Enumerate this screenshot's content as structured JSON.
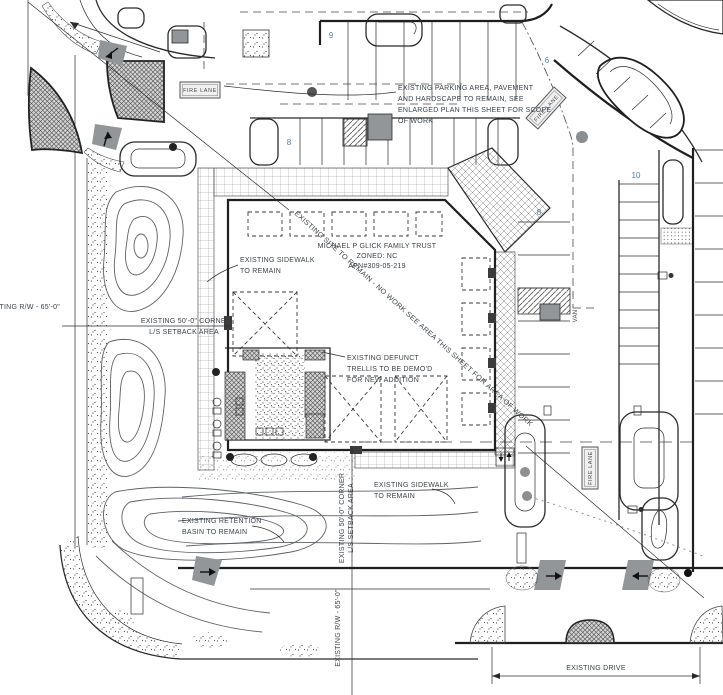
{
  "drawing": {
    "type": "architectural-site-plan",
    "colors": {
      "ink": "#2b2b2b",
      "label": "#3b4249",
      "count_blue": "#4a7cb5",
      "gray": "#939699"
    },
    "fire_lane": "FIRE LANE",
    "counts": {
      "top_row": "9",
      "entry_row": "6",
      "second_row": "8",
      "east_row": "8",
      "far_east_row": "10"
    },
    "labels": {
      "parking_note": {
        "l1": "EXISTING PARKING AREA, PAVEMENT",
        "l2": "AND HARDSCAPE TO REMAIN, SEE",
        "l3": "ENLARGED PLAN THIS SHEET FOR SCOPE",
        "l4": "OF WORK"
      },
      "owner": {
        "l1": "MICHAEL P GLICK FAMILY TRUST",
        "l2": "ZONED: NC",
        "l3": "APN#309-05-219"
      },
      "sidewalk_upper": {
        "l1": "EXISTING SIDEWALK",
        "l2": "TO REMAIN"
      },
      "corner_setback": {
        "l1": "EXISTING 50'-0\" CORNER",
        "l2": "L/S SETBACK AREA"
      },
      "rw_west": "EXISTING R/W - 65'-0\"",
      "trellis": {
        "l1": "EXISTING DEFUNCT",
        "l2": "TRELLIS TO BE DEMO'D",
        "l3": "FOR NEW ADDITION"
      },
      "site_note": "EXISTING SITE TO REMAIN - NO WORK SEE AREA THIS SHEET FOR AREA OF WORK",
      "sidewalk_lower": {
        "l1": "EXISTING SIDEWALK",
        "l2": "TO REMAIN"
      },
      "retention": {
        "l1": "EXISTING RETENTION",
        "l2": "BASIN TO REMAIN"
      },
      "setback_south": {
        "l1": "EXISTING 50'-0\" CORNER",
        "l2": "L/S SETBACK AREA"
      },
      "rw_south": "EXISTING R/W - 65'-0\"",
      "drive": "EXISTING DRIVE",
      "van": "VAN"
    }
  }
}
